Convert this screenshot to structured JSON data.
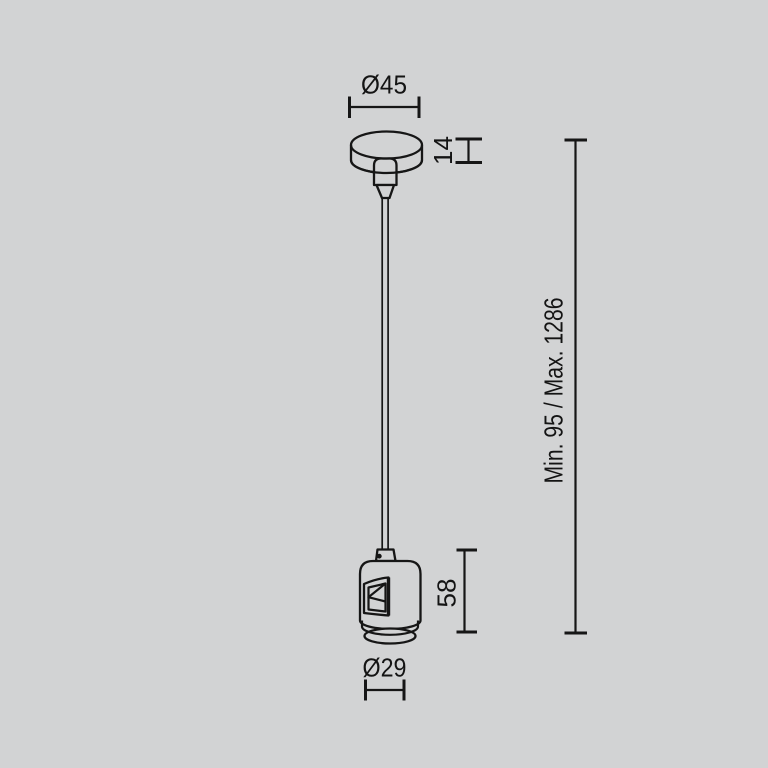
{
  "drawing": {
    "type": "technical-dimension-drawing",
    "subject": "pendant suspension kit with ceiling canopy, wire and lamp holder",
    "background_color": "#d2d3d4",
    "line_color": "#161616",
    "text_color": "#141414",
    "labels": {
      "canopy_diameter": "Ø45",
      "canopy_height": "14",
      "suspension_length": "Min. 95 / Max. 1286",
      "holder_height": "58",
      "holder_diameter": "Ø29"
    }
  }
}
